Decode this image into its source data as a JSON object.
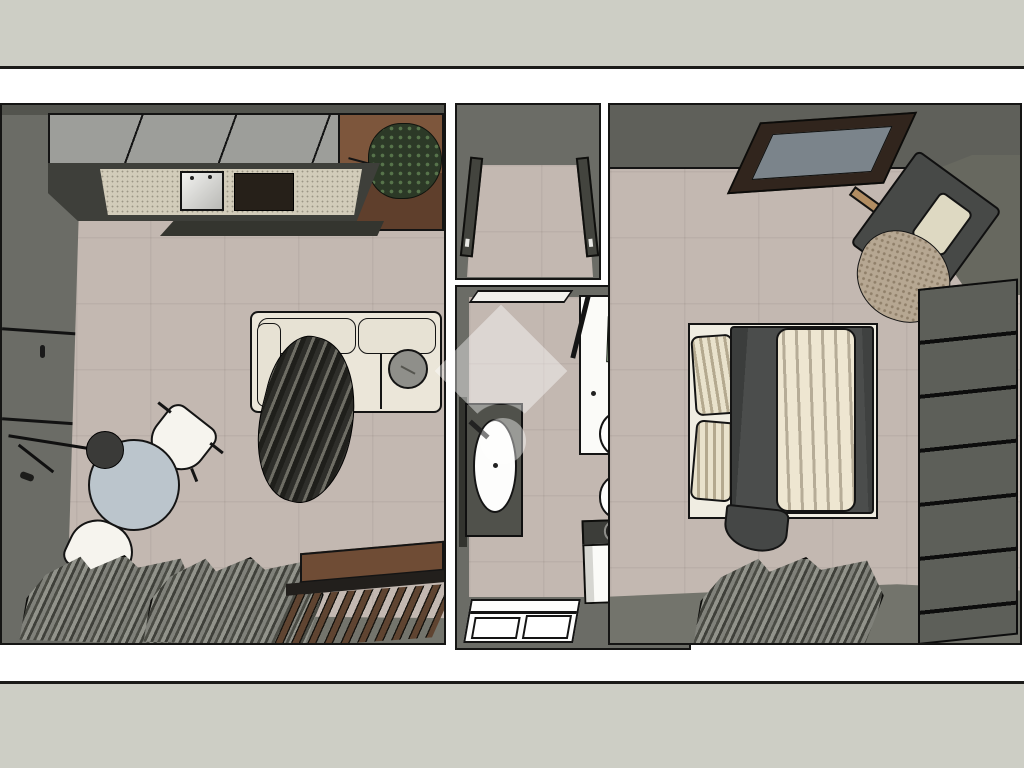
{
  "image": {
    "kind": "3d-floor-plan-render-top-view",
    "watermark_icon": "house-logo-watermark"
  },
  "palette": {
    "band": "#cdcec5",
    "frameLine": "#1b1b19",
    "floor": "#c3b8b1",
    "wallDark": "#5f605a",
    "wallMid": "#73746c",
    "wallFace": "#6b6c66",
    "wallTop": "#53544e",
    "cabinet": "#9d9e9a",
    "counterDark": "#3e3f3a",
    "countertop": "#d2ccba",
    "hob": "#262019",
    "wood": "#6f4c35",
    "plant": "#2c3927",
    "sofa": "#ebe6d9",
    "sofaCushionPart": "#e7e2d4",
    "cushion": "#8f8f8a",
    "table": "#bbc5cc",
    "chair": "#f6f4ee",
    "lamp": "#3a3a38",
    "benchFrame": "#221f1c",
    "doorSlab": "#43443e",
    "porcelain": "#fbfbf8",
    "towel": "#a9c4a2",
    "chrome": "#b8b8b4",
    "sinkCounter": "#50514b",
    "white": "#fdfdfc",
    "applianceTop": "#3c3d39",
    "frameWood": "#31251d",
    "frameInner": "#7b848b",
    "armchair": "#474947",
    "trim": "#b28d62",
    "pillow": "#ded9c2",
    "throw": "#b6a792",
    "duvet": "#4b4d4c",
    "duvetDrape": "#454746",
    "bedBase": "#f0ede2",
    "wardrobe": "#5d5f59",
    "cornerWall": "#67685f",
    "watermark": "rgba(255,255,255,0.42)"
  },
  "rooms": [
    {
      "id": "living-kitchen",
      "furniture": [
        "upper-cabinets",
        "kitchen-counter",
        "kitchen-sink",
        "cooktop",
        "wood-shelf",
        "plant",
        "sofa",
        "throw-blanket",
        "round-cushion",
        "dining-table",
        "dining-chair",
        "dining-chair",
        "floor-lamp",
        "window",
        "curtains",
        "slat-bench",
        "tall-cabinet-wall"
      ]
    },
    {
      "id": "entry-hall",
      "furniture": [
        "door-panel",
        "door-panel"
      ]
    },
    {
      "id": "bathroom",
      "furniture": [
        "door",
        "shower-tray",
        "towel",
        "washbasin",
        "bidet",
        "toilet",
        "flush-plate",
        "washing-machine",
        "window"
      ]
    },
    {
      "id": "bedroom",
      "furniture": [
        "picture-frame",
        "armchair",
        "armchair-pillow",
        "armchair-throw",
        "double-bed",
        "bed-pillows",
        "duvet",
        "striped-blanket",
        "wardrobe",
        "curtains",
        "window-wall"
      ]
    }
  ]
}
